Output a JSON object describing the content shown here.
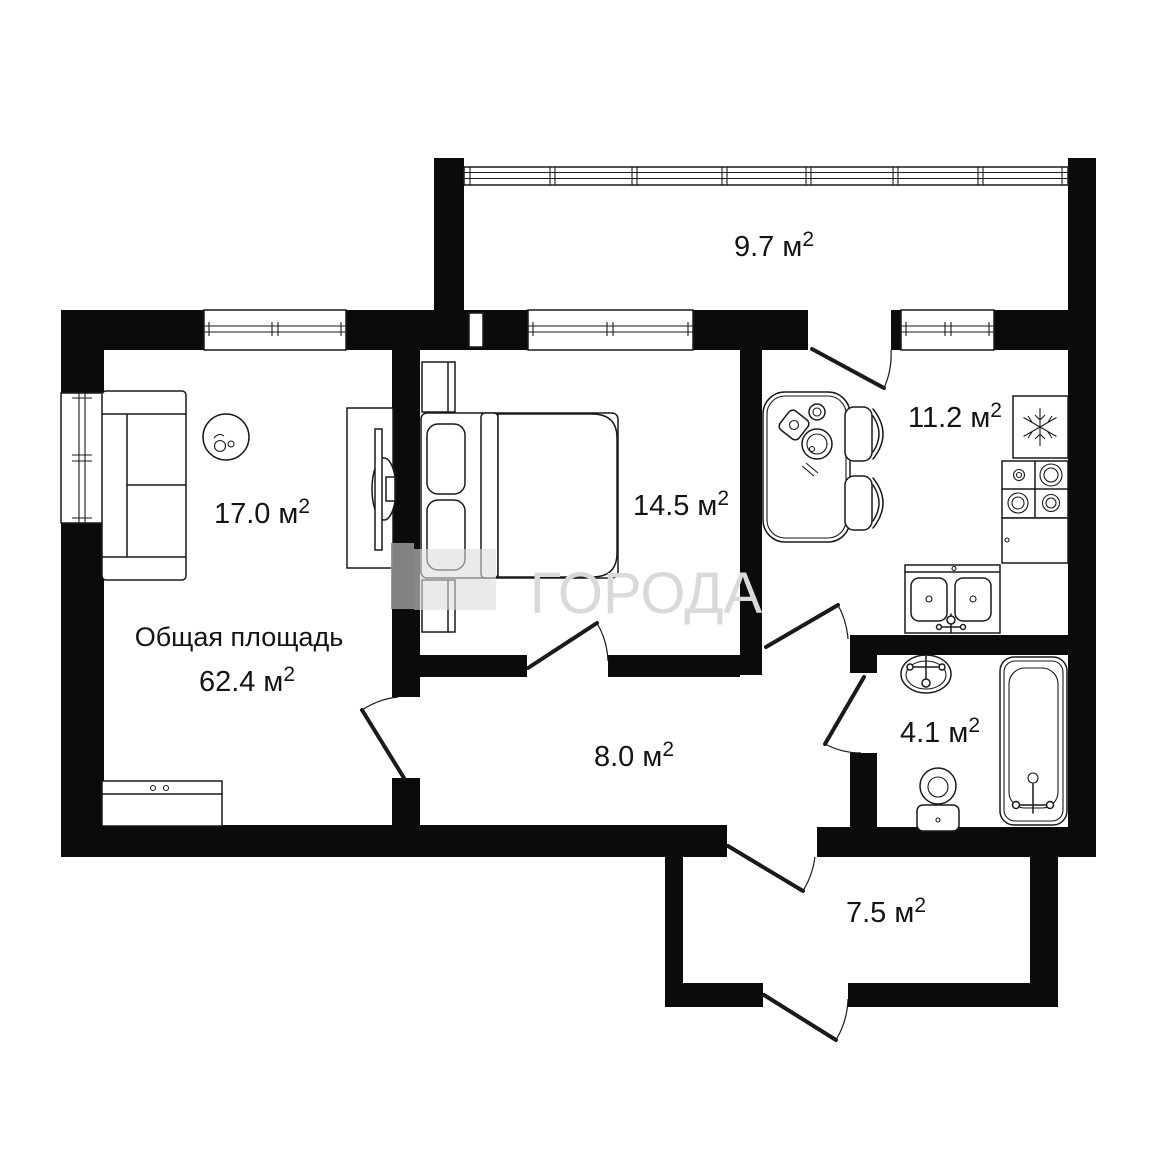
{
  "page": {
    "background": "#ffffff"
  },
  "watermark": {
    "text": "ГОРОДА",
    "text_color": "#d9d9d9",
    "bar_color": "#8f8f8f",
    "square_color": "#dcdcdc"
  },
  "plan": {
    "wall_color": "#0b0b0b",
    "line_color": "#1a1a1a",
    "total": {
      "title": "Общая площадь",
      "area": "62.4 м²"
    },
    "rooms": [
      {
        "id": "balcony",
        "area_label": "9.7 м²"
      },
      {
        "id": "living_room",
        "area_label": "17.0 м²"
      },
      {
        "id": "bedroom",
        "area_label": "14.5 м²"
      },
      {
        "id": "kitchen",
        "area_label": "11.2 м²"
      },
      {
        "id": "hallway",
        "area_label": "8.0 м²"
      },
      {
        "id": "bathroom",
        "area_label": "4.1 м²"
      },
      {
        "id": "corridor",
        "area_label": "7.5 м²"
      }
    ]
  }
}
